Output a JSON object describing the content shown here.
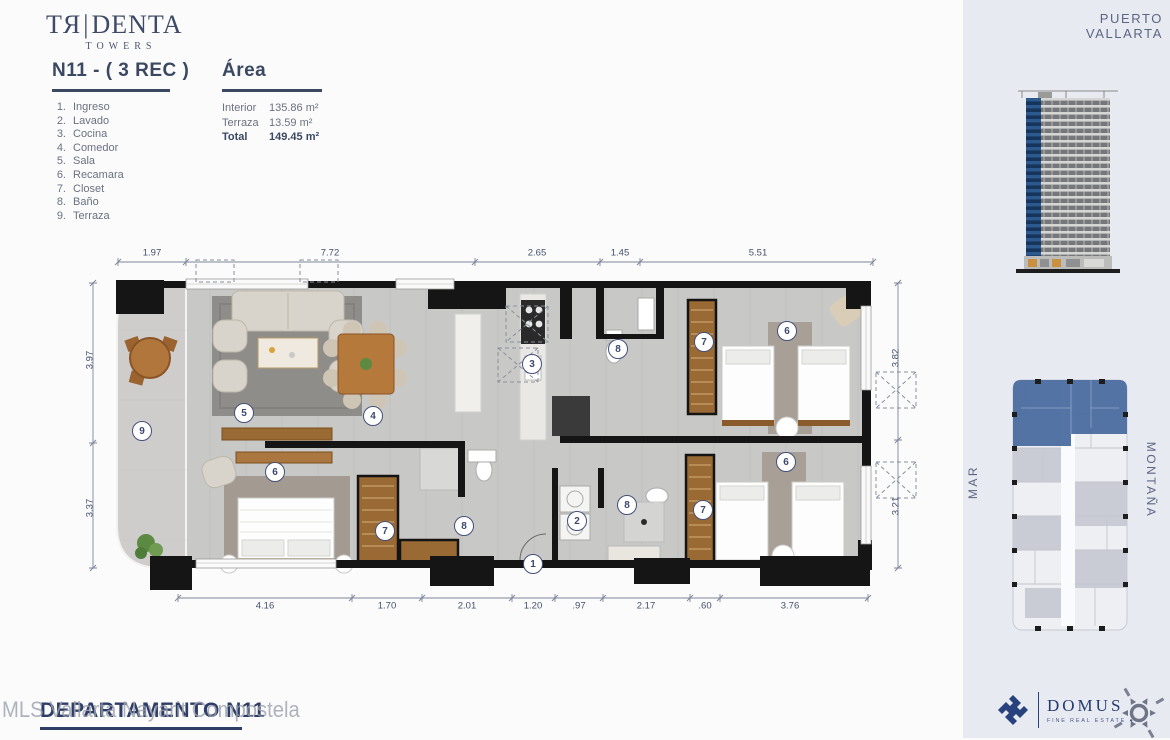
{
  "brand": {
    "logo_left": "TЯ",
    "logo_bar": "|",
    "logo_right": "DENTA",
    "logo_sub": "TOWERS"
  },
  "header": {
    "unit_title": "N11 - ( 3 REC )",
    "rooms": [
      {
        "n": "1.",
        "label": "Ingreso"
      },
      {
        "n": "2.",
        "label": "Lavado"
      },
      {
        "n": "3.",
        "label": "Cocina"
      },
      {
        "n": "4.",
        "label": "Comedor"
      },
      {
        "n": "5.",
        "label": "Sala"
      },
      {
        "n": "6.",
        "label": "Recamara"
      },
      {
        "n": "7.",
        "label": "Closet"
      },
      {
        "n": "8.",
        "label": "Baño"
      },
      {
        "n": "9.",
        "label": "Terraza"
      }
    ],
    "area_title": "Área",
    "area_rows": [
      {
        "label": "Interior",
        "value": "135.86 m²"
      },
      {
        "label": "Terraza",
        "value": "13.59 m²"
      },
      {
        "label": "Total",
        "value": "149.45 m²",
        "cls": "bold"
      }
    ]
  },
  "right_panel": {
    "location": "PUERTO VALLARTA",
    "sea_label": "MAR",
    "mountain_label": "MONTAÑA"
  },
  "plan": {
    "dims_top": [
      {
        "label": "1.97",
        "x": 152,
        "y": 253
      },
      {
        "label": "7.72",
        "x": 330,
        "y": 253
      },
      {
        "label": "2.65",
        "x": 537,
        "y": 253
      },
      {
        "label": "1.45",
        "x": 620,
        "y": 253
      },
      {
        "label": "5.51",
        "x": 758,
        "y": 253
      }
    ],
    "dims_bottom": [
      {
        "label": "4.16",
        "x": 265,
        "y": 606
      },
      {
        "label": "1.70",
        "x": 387,
        "y": 606
      },
      {
        "label": "2.01",
        "x": 467,
        "y": 606
      },
      {
        "label": "1.20",
        "x": 533,
        "y": 606
      },
      {
        "label": ".97",
        "x": 579,
        "y": 606
      },
      {
        "label": "2.17",
        "x": 646,
        "y": 606
      },
      {
        "label": ".60",
        "x": 705,
        "y": 606
      },
      {
        "label": "3.76",
        "x": 790,
        "y": 606
      }
    ],
    "dims_left": [
      {
        "label": "3.97",
        "x": 90,
        "y": 360
      },
      {
        "label": "3.37",
        "x": 90,
        "y": 508
      }
    ],
    "dims_right": [
      {
        "label": "3.82",
        "x": 896,
        "y": 358
      },
      {
        "label": "3.21",
        "x": 896,
        "y": 506
      }
    ],
    "markers": [
      {
        "n": "1",
        "x": 533,
        "y": 564
      },
      {
        "n": "2",
        "x": 577,
        "y": 521
      },
      {
        "n": "3",
        "x": 532,
        "y": 364
      },
      {
        "n": "4",
        "x": 373,
        "y": 416
      },
      {
        "n": "5",
        "x": 244,
        "y": 413
      },
      {
        "n": "6",
        "x": 275,
        "y": 472
      },
      {
        "n": "6",
        "x": 787,
        "y": 331
      },
      {
        "n": "6",
        "x": 786,
        "y": 462
      },
      {
        "n": "7",
        "x": 385,
        "y": 531
      },
      {
        "n": "7",
        "x": 704,
        "y": 342
      },
      {
        "n": "7",
        "x": 703,
        "y": 510
      },
      {
        "n": "8",
        "x": 464,
        "y": 526
      },
      {
        "n": "8",
        "x": 618,
        "y": 349
      },
      {
        "n": "8",
        "x": 627,
        "y": 505
      },
      {
        "n": "9",
        "x": 142,
        "y": 431
      }
    ]
  },
  "footer": {
    "watermark": "MLS Vallarta Nayarit Compostela",
    "sheet_label": "DEPARTAMENTO N11",
    "domus_name": "DOMUS",
    "domus_tagline": "FINE REAL ESTATE  ●"
  }
}
